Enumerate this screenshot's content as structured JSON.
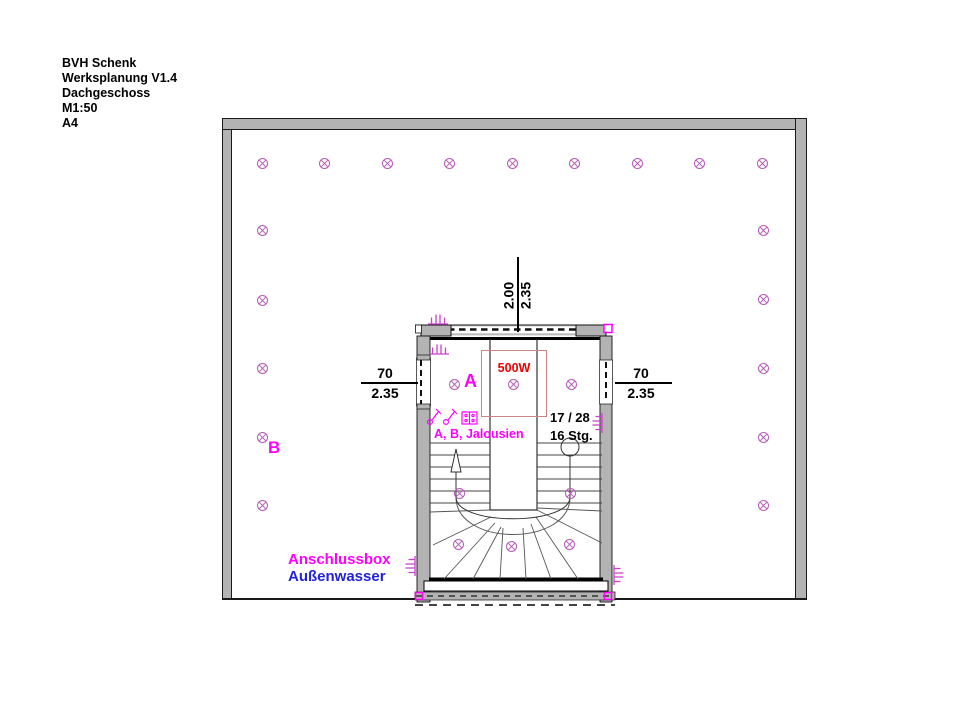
{
  "title_block": {
    "lines": [
      "BVH Schenk",
      "Werksplanung V1.4",
      "Dachgeschoss",
      "M1:50",
      "A4"
    ]
  },
  "labels": {
    "zone_a": "A",
    "zone_b": "B",
    "load": "500W",
    "jalousien": "A, B, Jalousien",
    "stair_ratio": "17 / 28",
    "stair_steps": "16 Stg.",
    "anschlussbox": "Anschlussbox",
    "aussenwasser": "Außenwasser"
  },
  "dimensions": {
    "top": {
      "a": "2.00",
      "b": "2.35"
    },
    "left": {
      "a": "70",
      "b": "2.35"
    },
    "right": {
      "a": "70",
      "b": "2.35"
    }
  },
  "colors": {
    "label_magenta": "#ff00ff",
    "light_violet": "#b45ab4",
    "symbol_magenta": "#cc3fcc",
    "water_blue": "#2222dd",
    "load_red": "#ee0000",
    "load_box_border": "#cc8484",
    "wall_gray": "#b3b3b3"
  },
  "plan": {
    "lights": [
      [
        262,
        163
      ],
      [
        324,
        163
      ],
      [
        387,
        163
      ],
      [
        449,
        163
      ],
      [
        512,
        163
      ],
      [
        574,
        163
      ],
      [
        637,
        163
      ],
      [
        699,
        163
      ],
      [
        762,
        163
      ],
      [
        262,
        230
      ],
      [
        262,
        300
      ],
      [
        262,
        368
      ],
      [
        262,
        437
      ],
      [
        262,
        505
      ],
      [
        763,
        230
      ],
      [
        763,
        299
      ],
      [
        763,
        368
      ],
      [
        763,
        437
      ],
      [
        763,
        505
      ],
      [
        454,
        384
      ],
      [
        513,
        384
      ],
      [
        571,
        384
      ],
      [
        459,
        493
      ],
      [
        570,
        493
      ],
      [
        458,
        544
      ],
      [
        511,
        546
      ],
      [
        569,
        544
      ]
    ],
    "connection_symbols": [
      {
        "x": 438,
        "y": 318,
        "rot": 0
      },
      {
        "x": 439,
        "y": 348,
        "rot": 0
      },
      {
        "x": 596,
        "y": 423,
        "rot": -90
      },
      {
        "x": 409,
        "y": 566,
        "rot": -90
      },
      {
        "x": 620,
        "y": 575,
        "rot": 90
      }
    ]
  }
}
